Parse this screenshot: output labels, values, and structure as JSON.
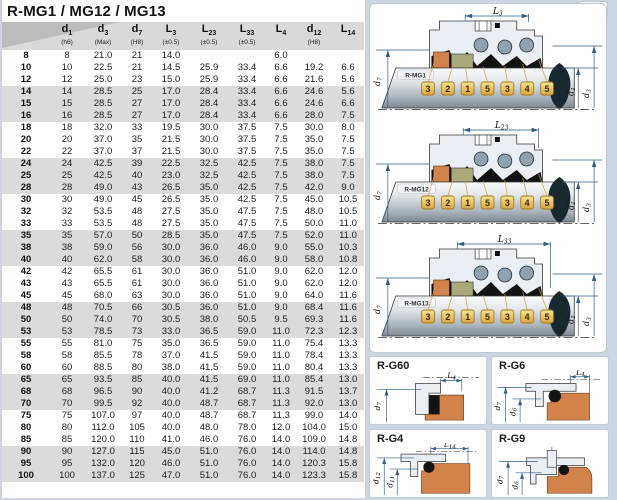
{
  "title": "R-MG1 / MG12 / MG13",
  "colors": {
    "page_bg": "#ccd6e1",
    "band_gray": "#dbdbdb",
    "header_gray": "#d9d9d9",
    "callout_gold": "#e3b54d",
    "part_orange": "#d2834a",
    "part_olive": "#aaa97c",
    "dim_blue": "#2e5f8a"
  },
  "table": {
    "columns": [
      {
        "base": "d",
        "sub": "1",
        "note": "(h6)"
      },
      {
        "base": "d",
        "sub": "3",
        "note": "(Max)"
      },
      {
        "base": "d",
        "sub": "7",
        "note": "(H8)"
      },
      {
        "base": "L",
        "sub": "3",
        "note": "(±0.5)"
      },
      {
        "base": "L",
        "sub": "23",
        "note": "(±0.5)"
      },
      {
        "base": "L",
        "sub": "33",
        "note": "(±0.5)"
      },
      {
        "base": "L",
        "sub": "4",
        "note": ""
      },
      {
        "base": "d",
        "sub": "12",
        "note": "(H8)"
      },
      {
        "base": "L",
        "sub": "14",
        "note": ""
      }
    ],
    "rows": [
      [
        "8",
        "8",
        "21.0",
        "21",
        "14.0",
        "",
        "",
        "6.0",
        "",
        ""
      ],
      [
        "10",
        "10",
        "22.5",
        "21",
        "14.5",
        "25.9",
        "33.4",
        "6.6",
        "19.2",
        "6.6"
      ],
      [
        "12",
        "12",
        "25.0",
        "23",
        "15.0",
        "25.9",
        "33.4",
        "6.6",
        "21.6",
        "5.6"
      ],
      [
        "14",
        "14",
        "28.5",
        "25",
        "17.0",
        "28.4",
        "33.4",
        "6.6",
        "24.6",
        "5.6"
      ],
      [
        "15",
        "15",
        "28.5",
        "27",
        "17.0",
        "28.4",
        "33.4",
        "6.6",
        "24.6",
        "6.6"
      ],
      [
        "16",
        "16",
        "28.5",
        "27",
        "17.0",
        "28.4",
        "33.4",
        "6.6",
        "28.0",
        "7.5"
      ],
      [
        "18",
        "18",
        "32.0",
        "33",
        "19.5",
        "30.0",
        "37.5",
        "7.5",
        "30.0",
        "8.0"
      ],
      [
        "20",
        "20",
        "37.0",
        "35",
        "21.5",
        "30.0",
        "37.5",
        "7.5",
        "35.0",
        "7.5"
      ],
      [
        "22",
        "22",
        "37.0",
        "37",
        "21.5",
        "30.0",
        "37.5",
        "7.5",
        "35.0",
        "7.5"
      ],
      [
        "24",
        "24",
        "42.5",
        "39",
        "22.5",
        "32.5",
        "42.5",
        "7.5",
        "38.0",
        "7.5"
      ],
      [
        "25",
        "25",
        "42.5",
        "40",
        "23.0",
        "32.5",
        "42.5",
        "7.5",
        "38.0",
        "7.5"
      ],
      [
        "28",
        "28",
        "49.0",
        "43",
        "26.5",
        "35.0",
        "42.5",
        "7.5",
        "42.0",
        "9.0"
      ],
      [
        "30",
        "30",
        "49.0",
        "45",
        "26.5",
        "35.0",
        "42.5",
        "7.5",
        "45.0",
        "10.5"
      ],
      [
        "32",
        "32",
        "53.5",
        "48",
        "27.5",
        "35.0",
        "47.5",
        "7.5",
        "48.0",
        "10.5"
      ],
      [
        "33",
        "33",
        "53.5",
        "48",
        "27.5",
        "35.0",
        "47.5",
        "7.5",
        "50.0",
        "11.0"
      ],
      [
        "35",
        "35",
        "57.0",
        "50",
        "28.5",
        "35.0",
        "47.5",
        "7.5",
        "52.0",
        "11.0"
      ],
      [
        "38",
        "38",
        "59.0",
        "56",
        "30.0",
        "36.0",
        "46.0",
        "9.0",
        "55.0",
        "10.3"
      ],
      [
        "40",
        "40",
        "62.0",
        "58",
        "30.0",
        "36.0",
        "46.0",
        "9.0",
        "58.0",
        "10.8"
      ],
      [
        "42",
        "42",
        "65.5",
        "61",
        "30.0",
        "36.0",
        "51.0",
        "9.0",
        "62.0",
        "12.0"
      ],
      [
        "43",
        "43",
        "65.5",
        "61",
        "30.0",
        "36.0",
        "51.0",
        "9.0",
        "62.0",
        "12.0"
      ],
      [
        "45",
        "45",
        "68.0",
        "63",
        "30.0",
        "36.0",
        "51.0",
        "9.0",
        "64.0",
        "11.6"
      ],
      [
        "48",
        "48",
        "70.5",
        "66",
        "30.5",
        "36.0",
        "51.0",
        "9.0",
        "68.4",
        "11.6"
      ],
      [
        "50",
        "50",
        "74.0",
        "70",
        "30.5",
        "38.0",
        "50.5",
        "9.5",
        "69.3",
        "11.6"
      ],
      [
        "53",
        "53",
        "78.5",
        "73",
        "33.0",
        "36.5",
        "59.0",
        "11.0",
        "72.3",
        "12.3"
      ],
      [
        "55",
        "55",
        "81.0",
        "75",
        "35.0",
        "36.5",
        "59.0",
        "11.0",
        "75.4",
        "13.3"
      ],
      [
        "58",
        "58",
        "85.5",
        "78",
        "37.0",
        "41.5",
        "59.0",
        "11.0",
        "78.4",
        "13.3"
      ],
      [
        "60",
        "60",
        "88.5",
        "80",
        "38.0",
        "41.5",
        "59.0",
        "11.0",
        "80.4",
        "13.3"
      ],
      [
        "65",
        "65",
        "93.5",
        "85",
        "40.0",
        "41.5",
        "69.0",
        "11.0",
        "85.4",
        "13.0"
      ],
      [
        "68",
        "68",
        "96.5",
        "90",
        "40.0",
        "41.2",
        "68.7",
        "11.3",
        "91.5",
        "13.7"
      ],
      [
        "70",
        "70",
        "99.5",
        "92",
        "40.0",
        "48.7",
        "68.7",
        "11.3",
        "92.0",
        "13.0"
      ],
      [
        "75",
        "75",
        "107.0",
        "97",
        "40.0",
        "48.7",
        "68.7",
        "11.3",
        "99.0",
        "14.0"
      ],
      [
        "80",
        "80",
        "112.0",
        "105",
        "40.0",
        "48.0",
        "78.0",
        "12.0",
        "104.0",
        "15.0"
      ],
      [
        "85",
        "85",
        "120.0",
        "110",
        "41.0",
        "46.0",
        "76.0",
        "14.0",
        "109.0",
        "14.8"
      ],
      [
        "90",
        "90",
        "127.0",
        "115",
        "45.0",
        "51.0",
        "76.0",
        "14.0",
        "114.0",
        "14.8"
      ],
      [
        "95",
        "95",
        "132.0",
        "120",
        "46.0",
        "51.0",
        "76.0",
        "14.0",
        "120.3",
        "15.8"
      ],
      [
        "100",
        "100",
        "137.0",
        "125",
        "47.0",
        "51.0",
        "76.0",
        "14.0",
        "123.3",
        "15.8"
      ]
    ]
  },
  "diagrams": {
    "mg1": {
      "label": "R-MG1",
      "dim_top": {
        "base": "L",
        "sub": "3"
      },
      "dim_left": {
        "base": "d",
        "sub": "7"
      },
      "dim_d1": {
        "base": "d",
        "sub": "1"
      },
      "dim_d3": {
        "base": "d",
        "sub": "3"
      },
      "callouts": [
        "3",
        "2",
        "1",
        "5",
        "3",
        "4",
        "5"
      ]
    },
    "mg12": {
      "label": "R-MG12",
      "dim_top": {
        "base": "L",
        "sub": "23"
      },
      "dim_left": {
        "base": "d",
        "sub": "7"
      },
      "dim_d1": {
        "base": "d",
        "sub": "1"
      },
      "dim_d3": {
        "base": "d",
        "sub": "3"
      },
      "callouts": [
        "3",
        "2",
        "1",
        "5",
        "3",
        "4",
        "5"
      ]
    },
    "mg13": {
      "label": "R-MG13",
      "dim_top": {
        "base": "L",
        "sub": "33"
      },
      "dim_left": {
        "base": "d",
        "sub": "7"
      },
      "dim_d1": {
        "base": "d",
        "sub": "1"
      },
      "dim_d3": {
        "base": "d",
        "sub": "3"
      },
      "callouts": [
        "3",
        "2",
        "1",
        "5",
        "3",
        "4",
        "5"
      ]
    }
  },
  "seats": {
    "g60": {
      "label": "R-G60",
      "dim_top": {
        "base": "L",
        "sub": "4"
      },
      "dims_left": [
        {
          "base": "d",
          "sub": "7"
        }
      ]
    },
    "g6": {
      "label": "R-G6",
      "dim_top": {
        "base": "L",
        "sub": "4"
      },
      "dims_left": [
        {
          "base": "d",
          "sub": "7"
        },
        {
          "base": "d",
          "sub": "6"
        }
      ]
    },
    "g4": {
      "label": "R-G4",
      "dim_top": {
        "base": "L",
        "sub": "14"
      },
      "dims_left": [
        {
          "base": "d",
          "sub": "12"
        },
        {
          "base": "d",
          "sub": "11"
        }
      ]
    },
    "g9": {
      "label": "R-G9",
      "dims_left": [
        {
          "base": "d",
          "sub": "7"
        },
        {
          "base": "d",
          "sub": "6"
        }
      ]
    }
  }
}
